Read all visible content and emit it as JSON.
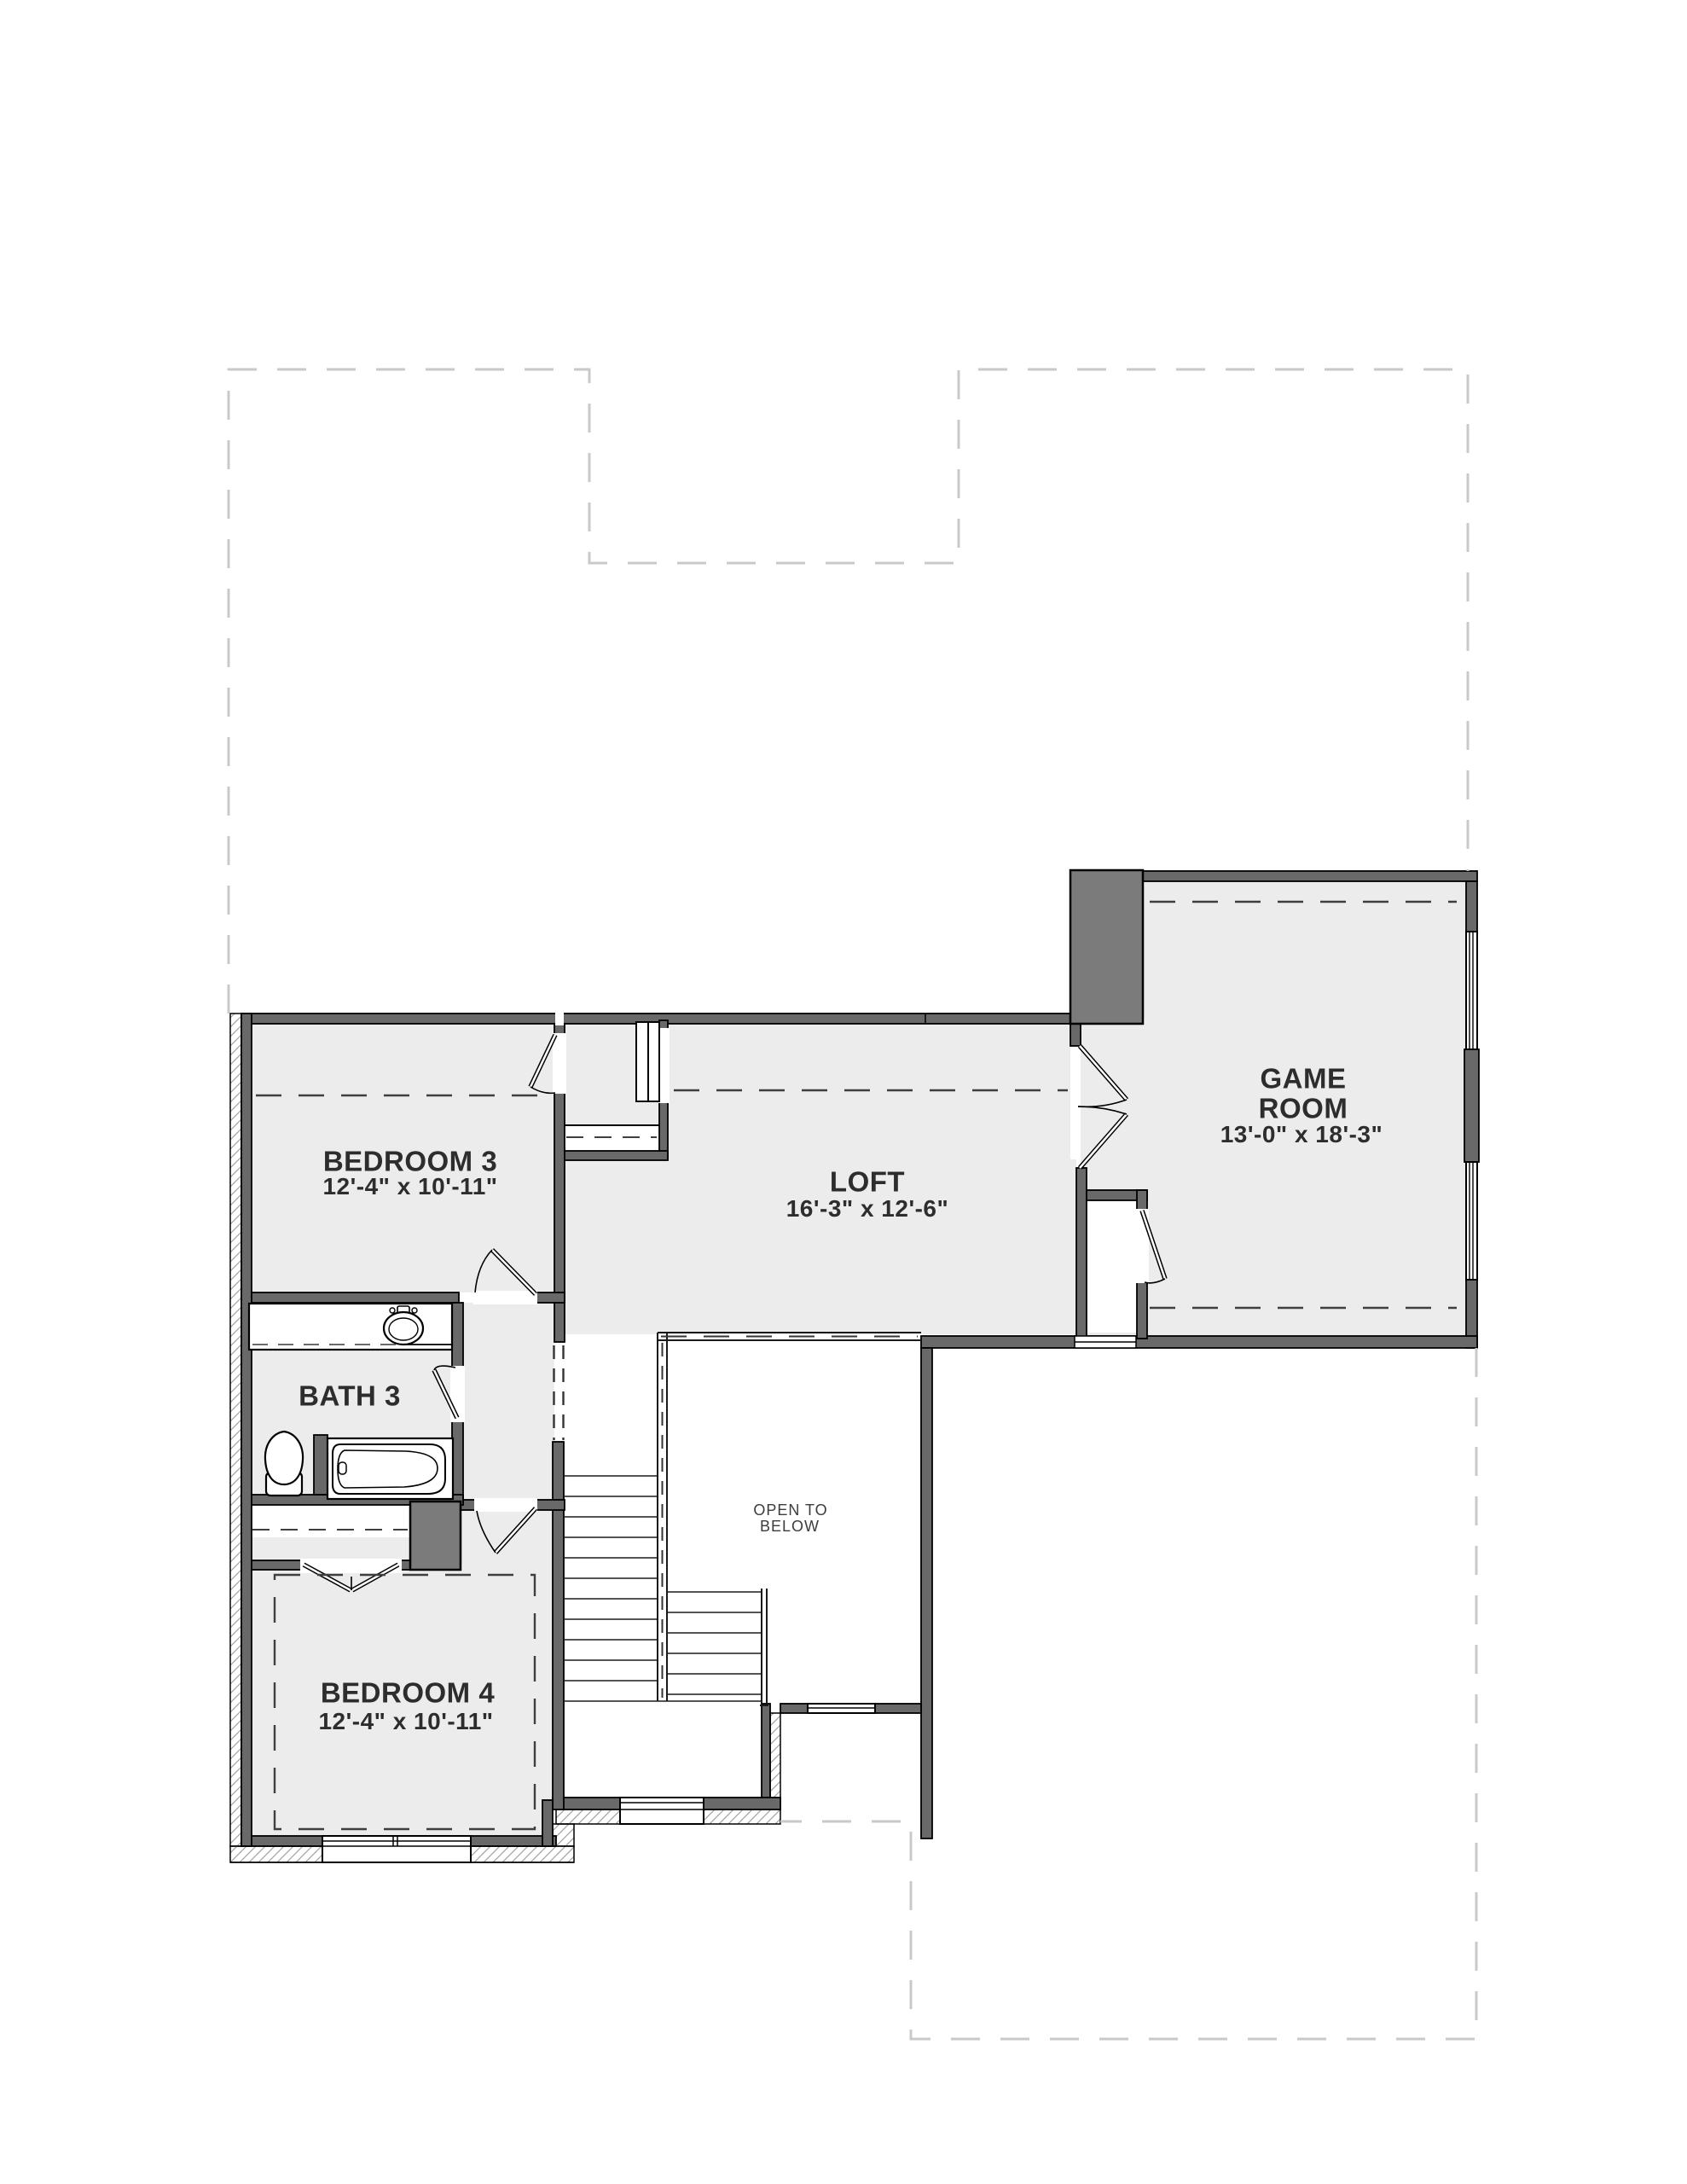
{
  "rooms": {
    "bedroom3": {
      "name": "BEDROOM 3",
      "dims": "12'-4\" x 10'-11\""
    },
    "loft": {
      "name": "LOFT",
      "dims": "16'-3\" x 12'-6\""
    },
    "game_room": {
      "name_line1": "GAME",
      "name_line2": "ROOM",
      "dims": "13'-0\" x 18'-3\""
    },
    "bath3": {
      "name": "BATH 3"
    },
    "bedroom4": {
      "name": "BEDROOM 4",
      "dims": "12'-4\" x 10'-11\""
    },
    "open_to_below": {
      "line1": "OPEN TO",
      "line2": "BELOW"
    }
  },
  "colors": {
    "wall": "#696969",
    "wall_dark": "#7b7b7b",
    "floor": "#ececec",
    "footprint_dash": "#c9c9c9",
    "label_text": "#2d2d2d"
  }
}
